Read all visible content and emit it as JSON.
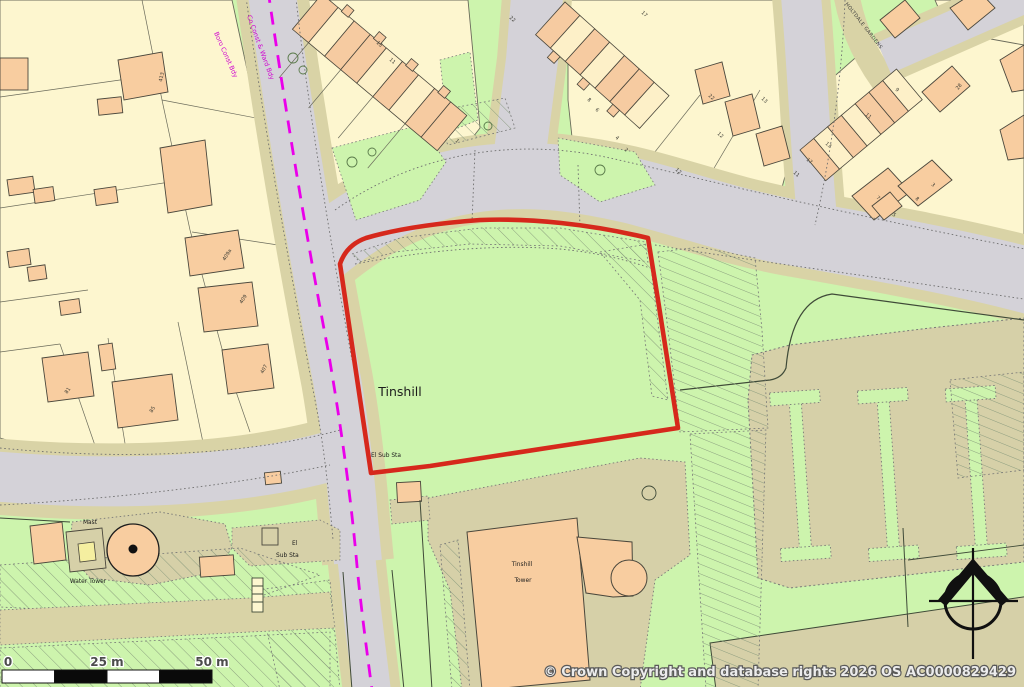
{
  "map_labels": {
    "place": "Tinshill",
    "tower_line1": "Tinshill",
    "tower_line2": "Tower",
    "el_sub_sta": "El Sub Sta",
    "el_short": "El",
    "sub_sta_short": "Sub Sta",
    "mast": "Mast",
    "water_tower": "Water Tower",
    "street_holtdale": "HOLTDALE GARDENS",
    "boundary_co_const": "Co Const & Ward Bdy",
    "boundary_boro_const": "Boro Const Bdy"
  },
  "house_numbers": [
    {
      "label": "413"
    },
    {
      "label": "409a"
    },
    {
      "label": "409"
    },
    {
      "label": "407"
    },
    {
      "label": "81"
    },
    {
      "label": "85"
    },
    {
      "label": "15"
    },
    {
      "label": "11"
    },
    {
      "label": "1"
    },
    {
      "label": "22"
    },
    {
      "label": "17"
    },
    {
      "label": "8"
    },
    {
      "label": "6"
    },
    {
      "label": "4"
    },
    {
      "label": "2"
    },
    {
      "label": "22"
    },
    {
      "label": "12"
    },
    {
      "label": "13"
    },
    {
      "label": "11"
    },
    {
      "label": "12"
    },
    {
      "label": "9"
    },
    {
      "label": "11"
    },
    {
      "label": "13"
    },
    {
      "label": "17"
    },
    {
      "label": "7"
    },
    {
      "label": "8"
    },
    {
      "label": "5"
    },
    {
      "label": "3"
    },
    {
      "label": "28"
    }
  ],
  "scale_bar": {
    "tick_0": "0",
    "tick_25": "25 m",
    "tick_50": "50 m"
  },
  "copyright_text": "© Crown Copyright and database rights 2026 OS AC0000829429",
  "colors": {
    "grass": "#cdf4ad",
    "road": "#d4d2d8",
    "verge": "#d9d3a6",
    "parcel": "#fdf6cf",
    "building": "#f8cda0",
    "site_boundary_red": "#d6281c",
    "admin_magenta": "#ea00ea"
  }
}
